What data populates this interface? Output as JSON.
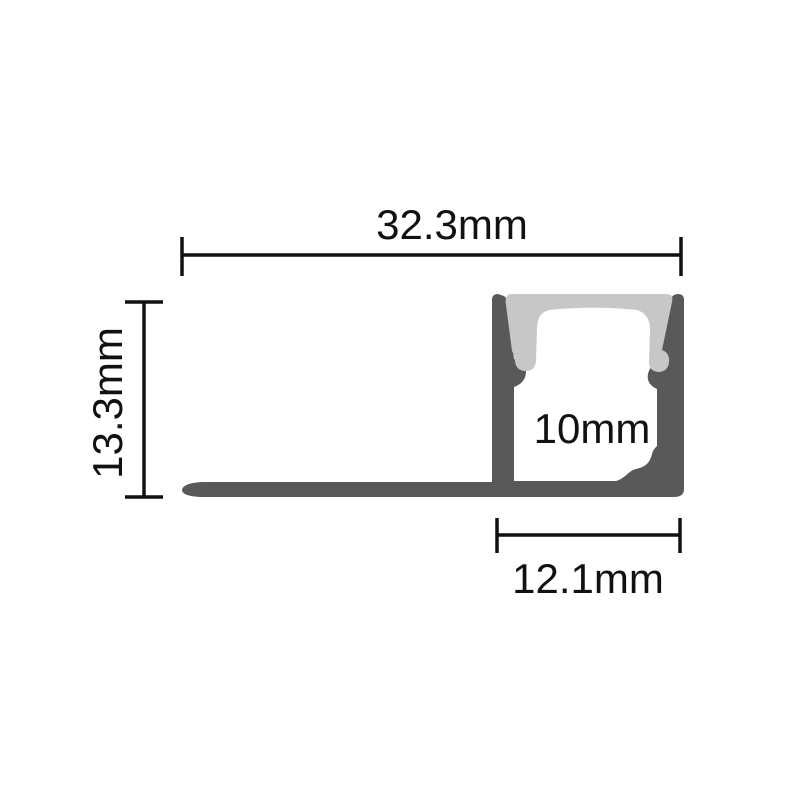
{
  "diagram": {
    "kind": "technical-cross-section-drawing",
    "subject": "recessed-led-aluminium-profile-with-diffuser",
    "labels": {
      "overall_width": "32.3mm",
      "overall_height": "13.3mm",
      "inner_width": "10mm",
      "channel_width": "12.1mm"
    },
    "colors": {
      "background": "#ffffff",
      "profile_body": "#595959",
      "diffuser": "#c7c7c7",
      "dimension": "#111111"
    }
  }
}
